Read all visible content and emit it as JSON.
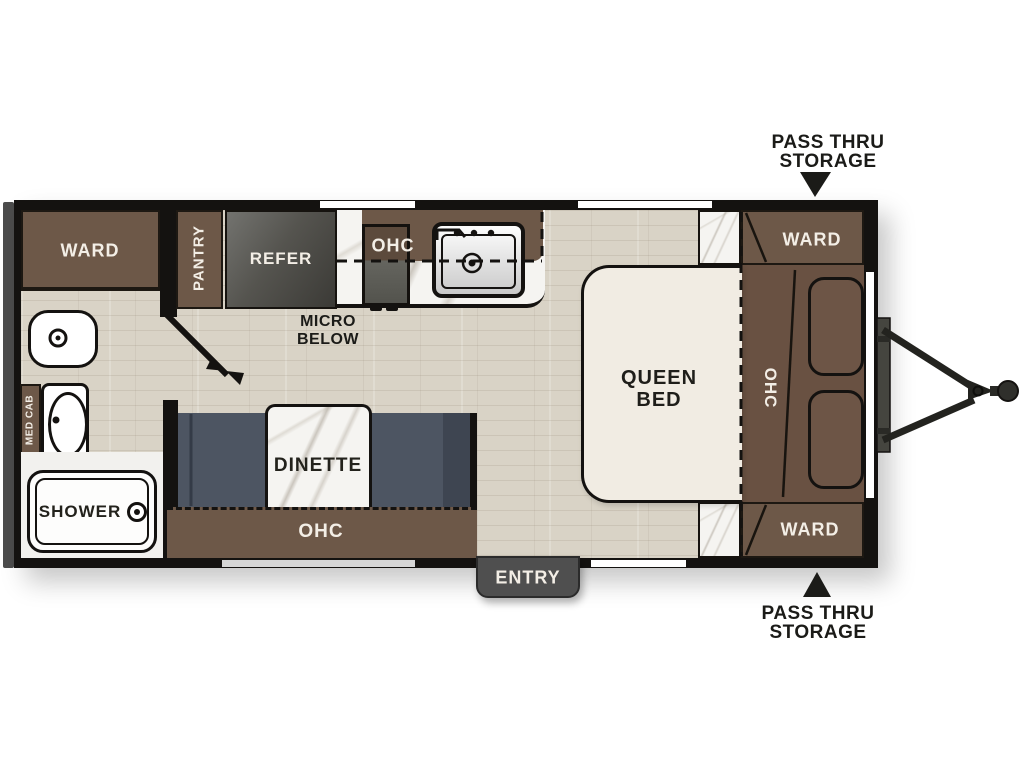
{
  "title": "Travel Trailer Floor Plan",
  "colors": {
    "cabinet_brown": "#6d5848",
    "headboard_brown": "#695142",
    "wall_black": "#141210",
    "floor_tan": "#d9d3c6",
    "refer_gray": "#4a4a46",
    "bench_slate": "#4d5562",
    "bed_cream": "#f1ece3",
    "entry_tab_gray": "#4f4f4f",
    "annotation_black": "#1b1b18"
  },
  "labels": {
    "ward_rear": "WARD",
    "pantry": "PANTRY",
    "refer": "REFER",
    "kitchen_ohc": "OHC",
    "micro_below": {
      "line1": "MICRO",
      "line2": "BELOW"
    },
    "med_cab": "MED CAB",
    "shower": "SHOWER",
    "dinette": "DINETTE",
    "dinette_ohc": "OHC",
    "entry": "ENTRY",
    "queen_bed": {
      "line1": "QUEEN",
      "line2": "BED"
    },
    "bed_ohc": "OHC",
    "ward_front_top": "WARD",
    "ward_front_bottom": "WARD"
  },
  "annotations": {
    "pass_thru_top": {
      "line1": "PASS THRU",
      "line2": "STORAGE"
    },
    "pass_thru_bottom": {
      "line1": "PASS THRU",
      "line2": "STORAGE"
    }
  }
}
